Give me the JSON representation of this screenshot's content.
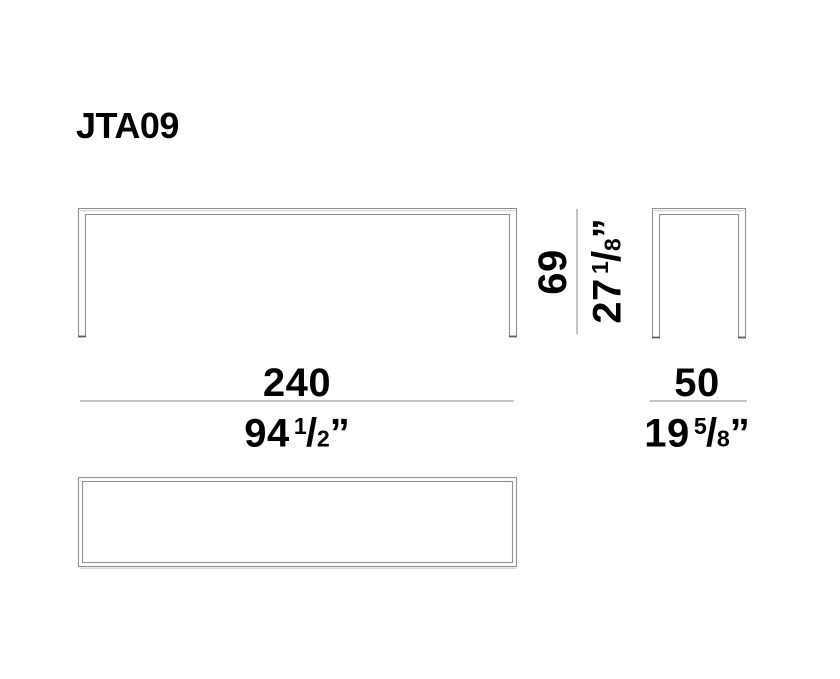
{
  "product": {
    "title": "JTA09"
  },
  "dimensions": {
    "width": {
      "metric": "240",
      "imperial": {
        "whole": "94",
        "numerator": "1",
        "denominator": "2"
      },
      "unit_mark": "”"
    },
    "depth": {
      "metric": "50",
      "imperial": {
        "whole": "19",
        "numerator": "5",
        "denominator": "8"
      },
      "unit_mark": "”"
    },
    "height": {
      "metric": "69",
      "imperial": {
        "whole": "27",
        "numerator": "1",
        "denominator": "8"
      },
      "unit_mark": "”"
    }
  },
  "glyphs": {
    "fraction_slash": "/"
  },
  "colors": {
    "outline": "#8f8f8f",
    "outline_light": "#c9c9c9",
    "foot": "#5f5f5f",
    "dimension_line": "#b3b3b3",
    "text": "#000000",
    "background": "#ffffff"
  }
}
